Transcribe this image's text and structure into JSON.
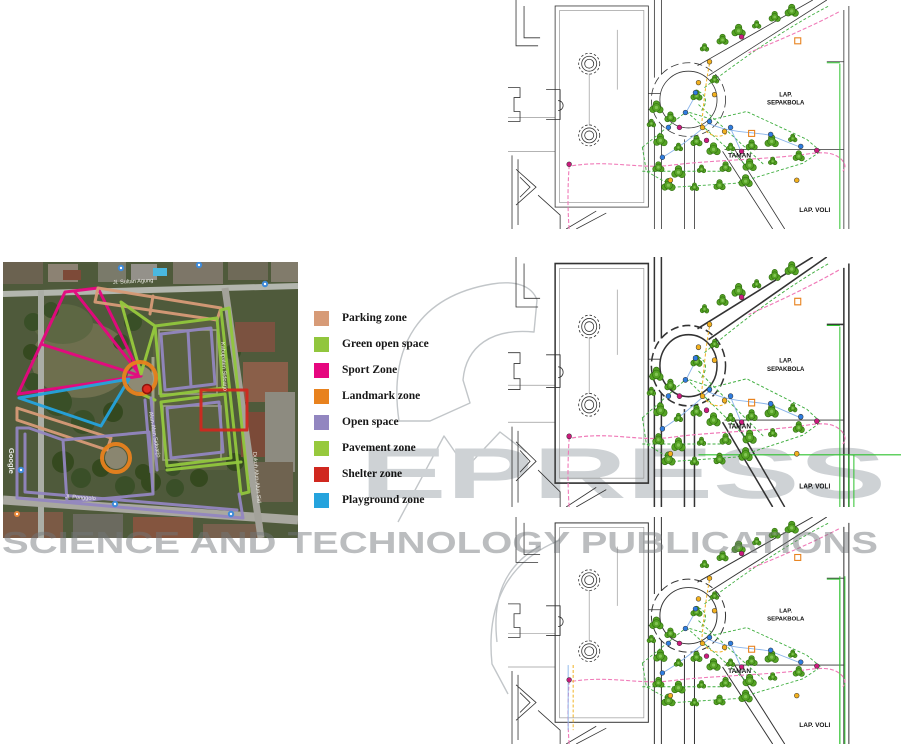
{
  "figure": {
    "map": {
      "attribution": "Google",
      "street_labels": {
        "top": "Jl. Sultan Agung",
        "right": "Kabupaten Sidoarjo",
        "center": "Alun-Alun Sidoarjo",
        "bottom": "Jl. Ponggolo",
        "right_bottom": "Dukuh Alun-Alun Sid"
      }
    },
    "legend": {
      "items": [
        {
          "key": "parking",
          "label": "Parking zone",
          "color": "#d79b77"
        },
        {
          "key": "green_open",
          "label": "Green open space",
          "color": "#91c63d"
        },
        {
          "key": "sport",
          "label": "Sport Zone",
          "color": "#e6067f"
        },
        {
          "key": "landmark",
          "label": "Landmark zone",
          "color": "#e8821e"
        },
        {
          "key": "open_space",
          "label": "Open space",
          "color": "#9286c0"
        },
        {
          "key": "pavement",
          "label": "Pavement zone",
          "color": "#97c93d"
        },
        {
          "key": "shelter",
          "label": "Shelter zone",
          "color": "#d0281f"
        },
        {
          "key": "playground",
          "label": "Playground zone",
          "color": "#25a3dd"
        }
      ]
    },
    "plans": [
      {
        "labels": {
          "field_top_1": "LAP.",
          "field_top_2": "SEPAKBOLA",
          "garden": "TAMAN",
          "field_bottom": "LAP. VOLI"
        }
      },
      {
        "labels": {
          "field_top_1": "LAP.",
          "field_top_2": "SEPAKBOLA",
          "garden": "TAMAN",
          "field_bottom": "LAP. VOLI"
        }
      },
      {
        "labels": {
          "field_top_1": "LAP.",
          "field_top_2": "SEPAKBOLA",
          "garden": "TAMAN",
          "field_bottom": "LAP. VOLI"
        }
      }
    ],
    "watermark": {
      "wordmark": "EPRESS",
      "tagline": "SCIENCE AND TECHNOLOGY PUBLICATIONS",
      "color": "#c9cdd0"
    }
  }
}
